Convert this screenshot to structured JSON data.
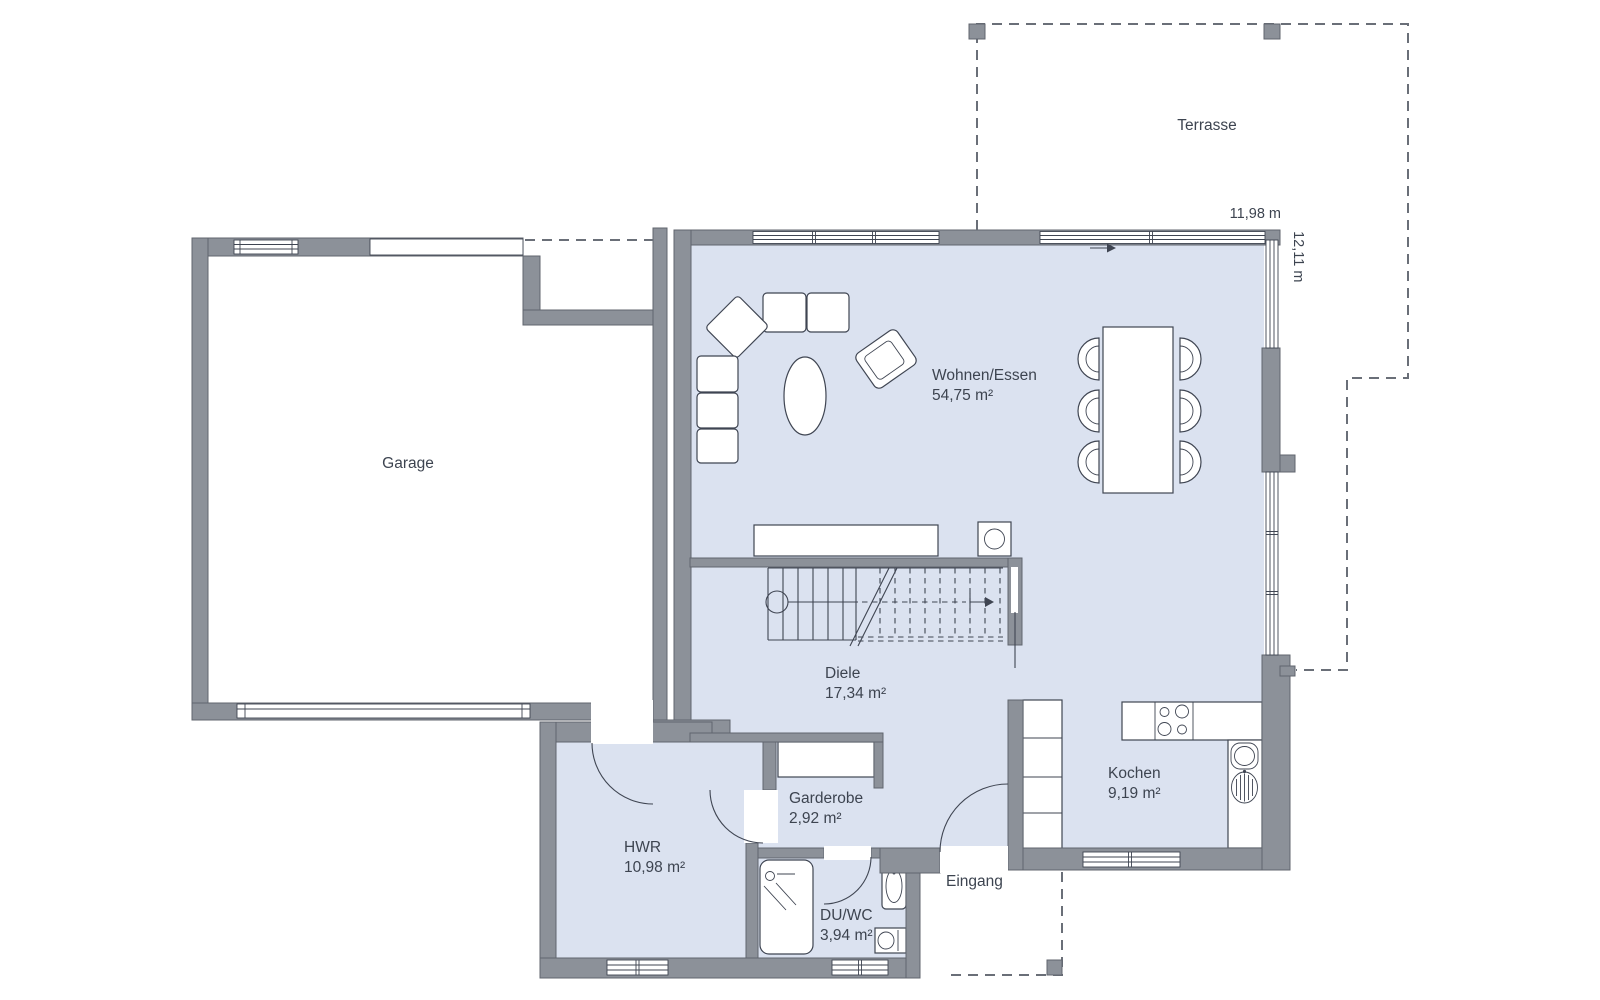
{
  "plan": {
    "rooms": {
      "garage": {
        "label": "Garage"
      },
      "terrasse": {
        "label": "Terrasse"
      },
      "wohnen_essen": {
        "label": "Wohnen/Essen",
        "area": "54,75 m²"
      },
      "diele": {
        "label": "Diele",
        "area": "17,34 m²"
      },
      "garderobe": {
        "label": "Garderobe",
        "area": "2,92 m²"
      },
      "hwr": {
        "label": "HWR",
        "area": "10,98 m²"
      },
      "du_wc": {
        "label": "DU/WC",
        "area": "3,94 m²"
      },
      "kochen": {
        "label": "Kochen",
        "area": "9,19 m²"
      },
      "eingang": {
        "label": "Eingang"
      }
    },
    "dimensions": {
      "width": "11,98 m",
      "depth": "12,11 m"
    },
    "icons": [
      "stairs-direction-arrow",
      "sliding-door-arrow"
    ],
    "colors": {
      "wall": "#8c9199",
      "wall_outline": "#60656e",
      "floor": "#dbe2f0",
      "outside": "#ffffff",
      "line": "#3f4552",
      "dash": "#6a6f78",
      "text": "#3d4450"
    }
  }
}
